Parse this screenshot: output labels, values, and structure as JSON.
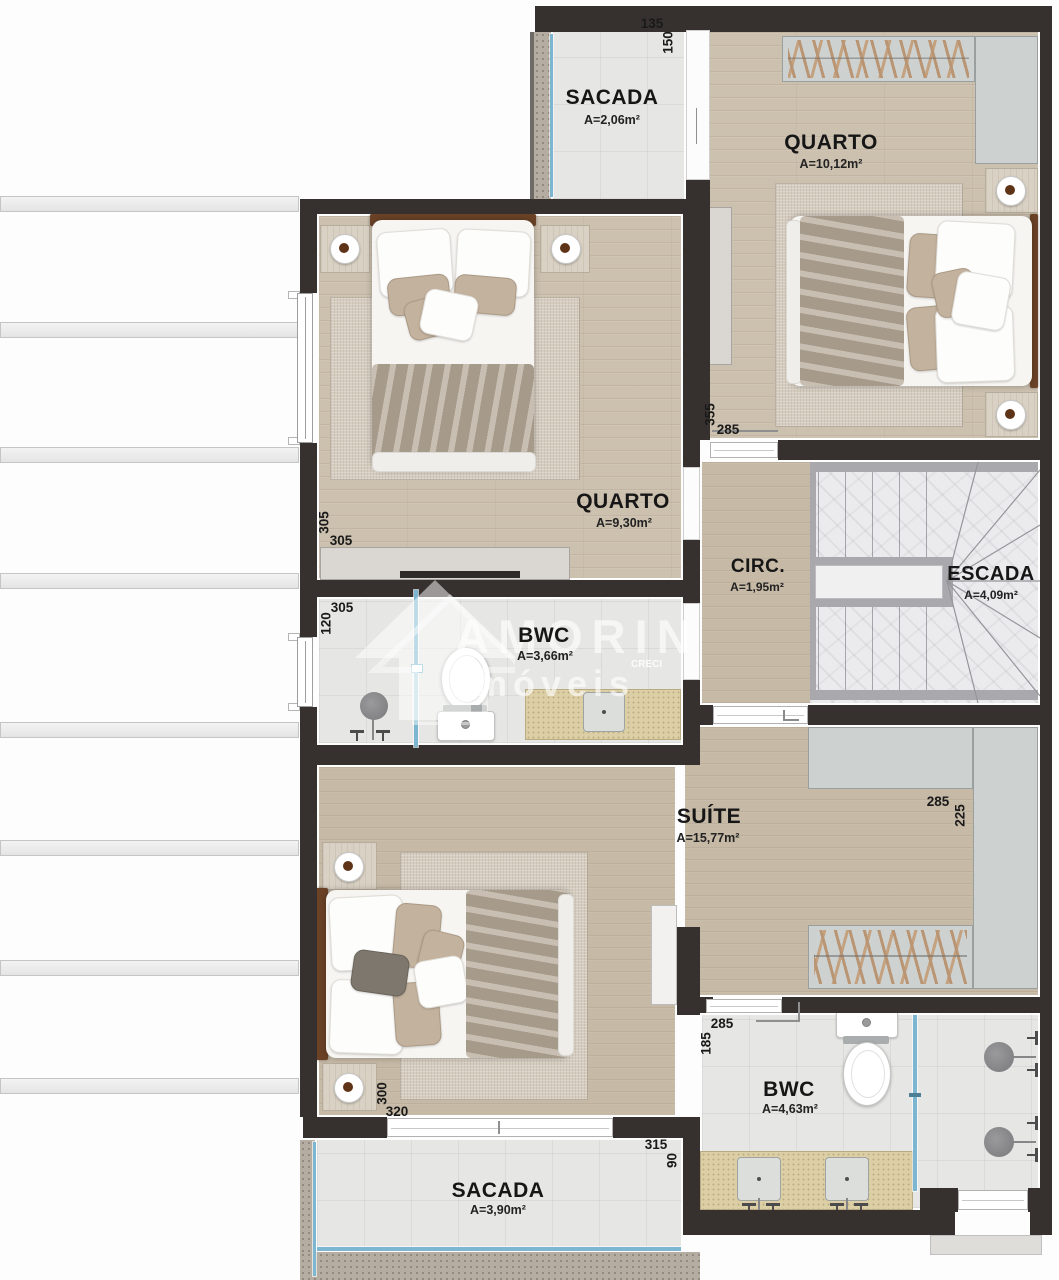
{
  "labels": {
    "sacada_top": {
      "name": "SACADA",
      "area": "A=2,06m²"
    },
    "quarto_right": {
      "name": "QUARTO",
      "area": "A=10,12m²"
    },
    "quarto_left": {
      "name": "QUARTO",
      "area": "A=9,30m²"
    },
    "bwc_top": {
      "name": "BWC",
      "area": "A=3,66m²"
    },
    "circ": {
      "name": "CIRC.",
      "area": "A=1,95m²"
    },
    "escada": {
      "name": "ESCADA",
      "area": "A=4,09m²"
    },
    "suite": {
      "name": "SUÍTE",
      "area": "A=15,77m²"
    },
    "bwc_bottom": {
      "name": "BWC",
      "area": "A=4,63m²"
    },
    "sacada_bottom": {
      "name": "SACADA",
      "area": "A=3,90m²"
    }
  },
  "dims": {
    "sacada_top_w": "135",
    "sacada_top_h": "150",
    "quarto_right_h": "355",
    "quarto_right_w": "285",
    "quarto_left_h": "305",
    "quarto_left_w": "305",
    "bwc_top_w": "305",
    "bwc_top_h": "120",
    "suite_closet_w": "285",
    "suite_closet_h": "225",
    "suite_bed_h": "300",
    "suite_bed_w": "320",
    "sacada_bottom_w": "315",
    "sacada_bottom_h": "90",
    "bwc_bottom_w": "285",
    "bwc_bottom_h": "185"
  },
  "watermark": {
    "brand": "AMORIN",
    "sub": "imóveis",
    "creci": "CRECI"
  },
  "colors": {
    "wall": "#36312e",
    "wood": "#ccc0af",
    "tile": "#e6e6e4",
    "glass": "#7cb6d0",
    "counter": "#dccfa6",
    "stone": "#b5aca2"
  }
}
